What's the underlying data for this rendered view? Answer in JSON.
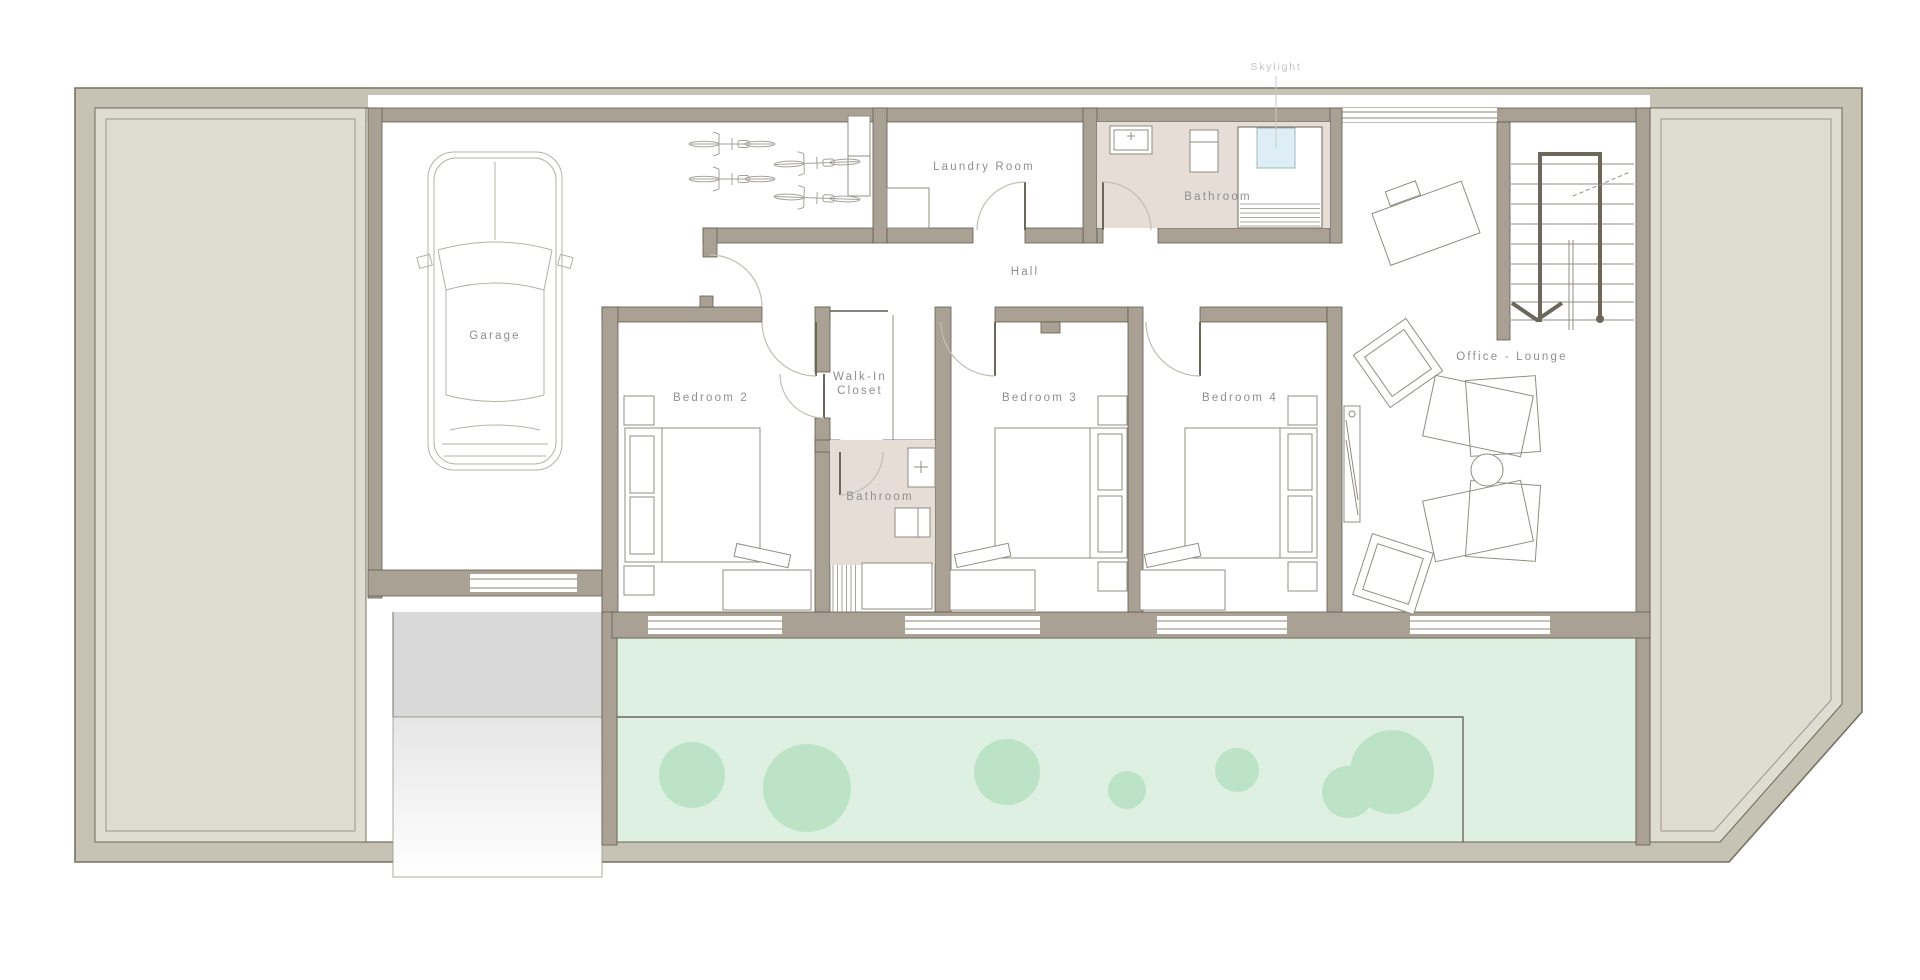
{
  "title": "House Floor Plan",
  "colors": {
    "lot_wall": "#c7c3b4",
    "interior_wall": "#a9a294",
    "side_yard": "#dfdcd2",
    "garden": "#def0e2",
    "garden_bush": "#bce3c6",
    "bathroom_floor": "#e6ddd6",
    "skylight_glass": "#ddeff5",
    "driveway": "#d9d9d9",
    "label_text": "#8f8f8f"
  },
  "rooms": {
    "garage": {
      "label": "Garage"
    },
    "laundry_room": {
      "label": "Laundry Room"
    },
    "bathroom_top": {
      "label": "Bathroom"
    },
    "hall": {
      "label": "Hall"
    },
    "bedroom2": {
      "label": "Bedroom 2"
    },
    "walk_in_closet": {
      "label": "Walk-In Closet",
      "line1": "Walk-In",
      "line2": "Closet"
    },
    "bathroom_mid": {
      "label": "Bathroom"
    },
    "bedroom3": {
      "label": "Bedroom 3"
    },
    "bedroom4": {
      "label": "Bedroom 4"
    },
    "office_lounge": {
      "label": "Office - Lounge"
    }
  },
  "annotations": {
    "skylight": {
      "label": "Skylight"
    }
  }
}
